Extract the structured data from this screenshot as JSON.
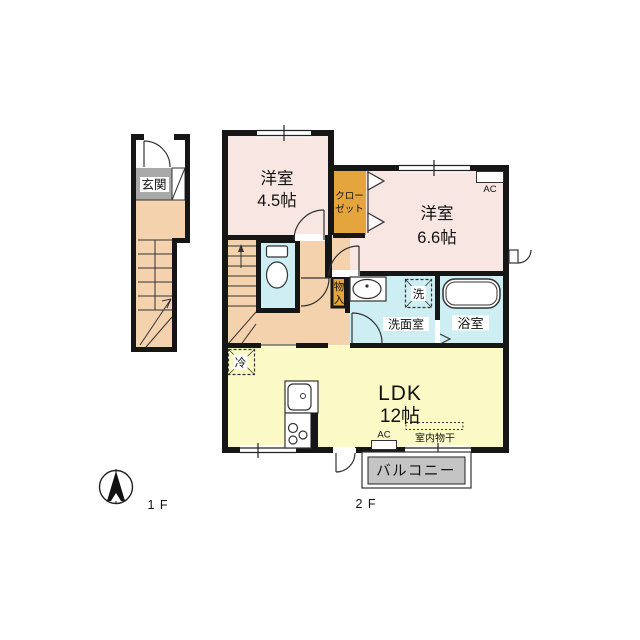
{
  "plan": {
    "floor_labels": {
      "first": "1 F",
      "second": "2 F"
    },
    "rooms": {
      "genkan": "玄関",
      "west_a_name": "洋室",
      "west_a_size": "4.5帖",
      "west_b_name": "洋室",
      "west_b_size": "6.6帖",
      "closet_line1": "クロー",
      "closet_line2": "ゼット",
      "storage_char1": "物",
      "storage_char2": "入",
      "washroom": "洗面室",
      "bathroom": "浴室",
      "ldk_name": "LDK",
      "ldk_size": "12帖",
      "balcony": "バルコニー"
    },
    "fixtures": {
      "washer": "洗",
      "fridge": "冷",
      "ac_bedroom": "AC",
      "ac_ldk": "AC",
      "indoor_drying": "室内物干"
    },
    "colors": {
      "room_pink": "#f8e6e3",
      "hall_peach": "#f5d2ae",
      "closet_orange": "#e4a53d",
      "wet_blue": "#cdeef2",
      "ldk_yellow": "#fbfac6",
      "genkan_gray": "#a9a9a9",
      "balcony_gray": "#c4c4c4",
      "wall": "#161616"
    }
  }
}
